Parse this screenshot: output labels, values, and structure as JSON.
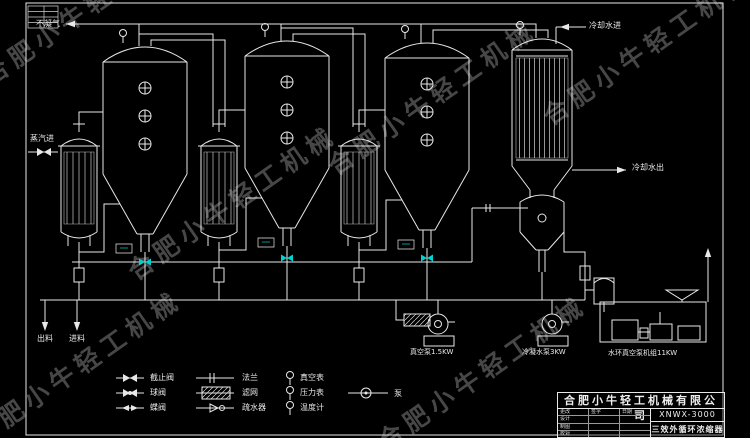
{
  "watermark": {
    "text": "合肥小牛轻工机械"
  },
  "labels": {
    "non_condensable": "不凝气",
    "steam_in": "蒸汽进",
    "cooling_water_in": "冷却水进",
    "cooling_water_out": "冷却水出",
    "discharge": "出料",
    "feed": "进料",
    "pump_left": "真空泵1.5KW",
    "pump_right": "冷凝水泵3KW",
    "vacuum_unit": "水环真空泵机组11KW"
  },
  "legend": {
    "items": [
      {
        "symbol": "globe-valve",
        "label": "截止阀"
      },
      {
        "symbol": "ball-valve",
        "label": "球阀"
      },
      {
        "symbol": "butterfly-valve",
        "label": "蝶阀"
      },
      {
        "symbol": "flange",
        "label": "法兰"
      },
      {
        "symbol": "filter",
        "label": "滤网"
      },
      {
        "symbol": "steam-trap",
        "label": "疏水器"
      },
      {
        "symbol": "vacuum-gauge",
        "label": "真空表"
      },
      {
        "symbol": "pressure-gauge",
        "label": "压力表"
      },
      {
        "symbol": "thermometer",
        "label": "温度计"
      },
      {
        "symbol": "pump",
        "label": "泵"
      }
    ]
  },
  "title_block": {
    "company": "合肥小牛轻工机械有限公司",
    "model": "XNWX-3000",
    "drawing_title": "三效外循环浓缩器",
    "col_headers": [
      "更改",
      "签字",
      "日期"
    ],
    "rows": [
      "设计",
      "制图",
      "校对"
    ]
  },
  "colors": {
    "line": "#e8e8e8",
    "accent_cyan": "#00d2d2",
    "watermark_gray": "#474747"
  }
}
